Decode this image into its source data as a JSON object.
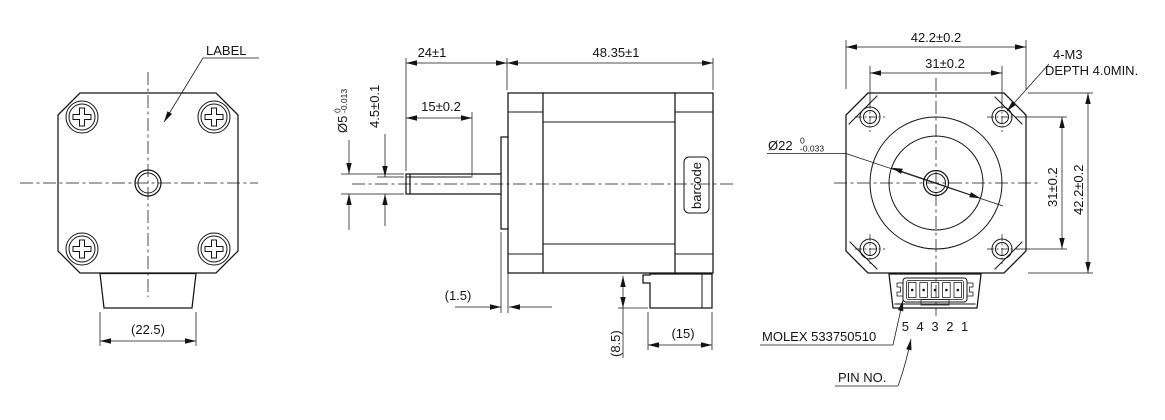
{
  "front_view": {
    "label_callout": "LABEL",
    "connector_width": "(22.5)"
  },
  "side_view": {
    "shaft_length": "24±1",
    "body_length": "48.35±1",
    "shaft_flat_length": "15±0.2",
    "shaft_diameter": "Ø5",
    "shaft_diameter_tol_upper": "0",
    "shaft_diameter_tol_lower": "-0.013",
    "shaft_flat_height": "4.5±0.1",
    "barcode_label": "barcode",
    "pilot_thickness": "(1.5)",
    "connector_height": "(8.5)",
    "connector_length": "(15)"
  },
  "rear_view": {
    "body_width": "42.2±0.2",
    "mount_hole_spacing_top": "31±0.2",
    "mount_thread_callout": "4-M3",
    "mount_depth_callout": "DEPTH 4.0MIN.",
    "pilot_diameter": "Ø22",
    "pilot_tol_upper": "0",
    "pilot_tol_lower": "-0.033",
    "mount_hole_spacing_right": "31±0.2",
    "body_height": "42.2±0.2",
    "connector_callout": "MOLEX 533750510",
    "pin_numbers": "5 4 3 2 1",
    "pin_label": "PIN NO."
  },
  "colors": {
    "background": "#ffffff",
    "line": "#141414"
  }
}
